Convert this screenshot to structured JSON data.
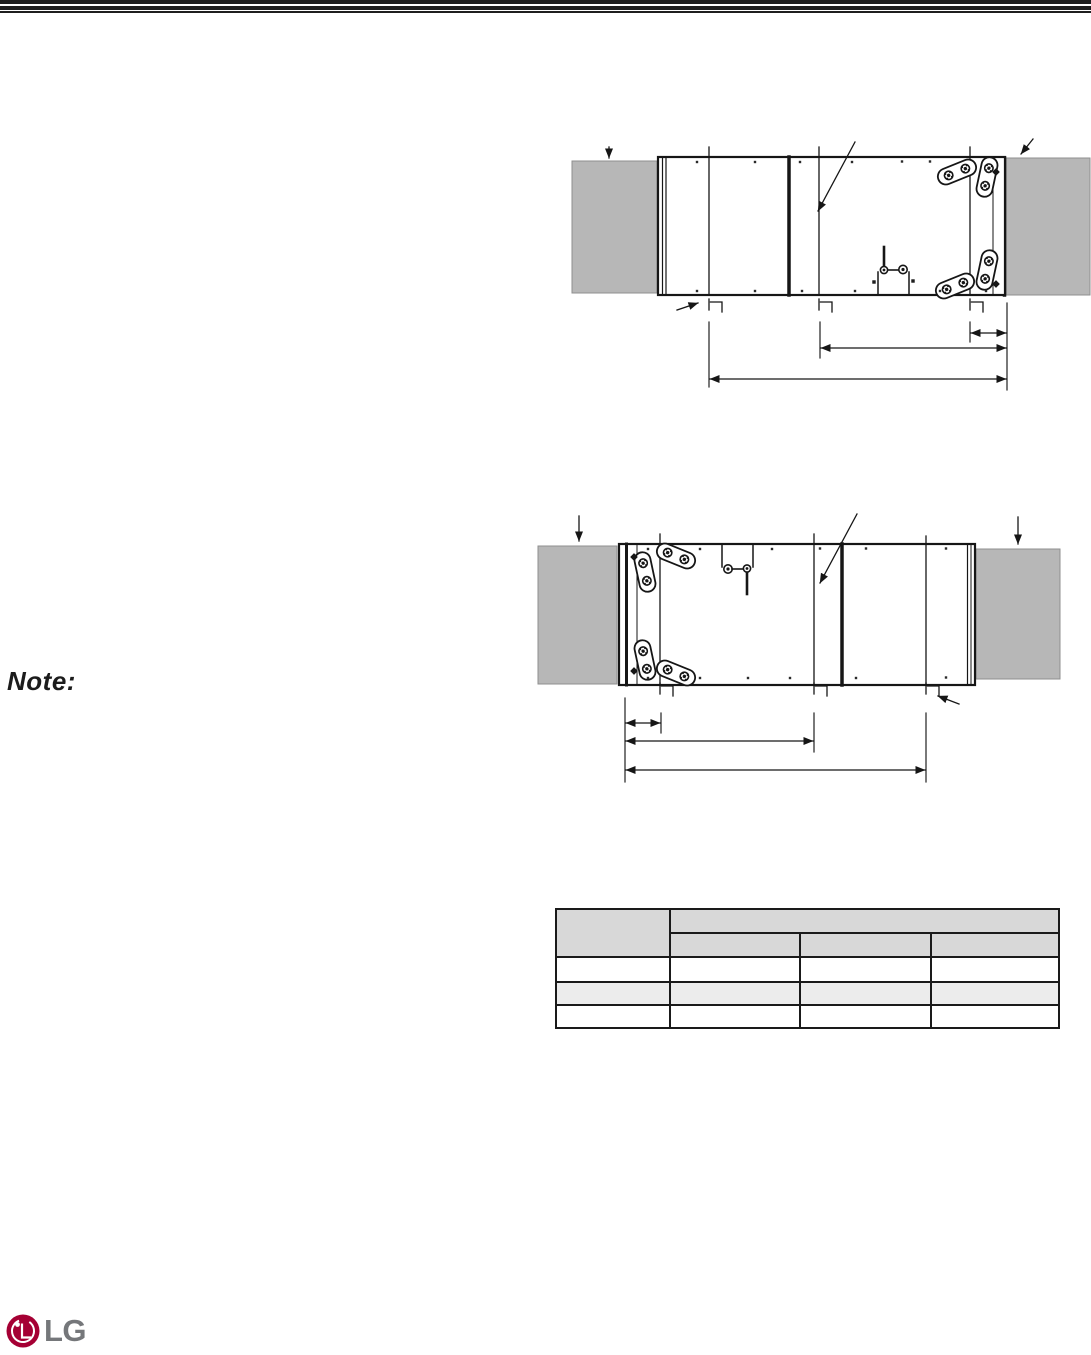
{
  "page": {
    "background": "#ffffff"
  },
  "header": {
    "bar_color": "#1f1f1f"
  },
  "note": {
    "label": "Note:"
  },
  "figures": {
    "panel_fill": "#b7b7b7",
    "line_color": "#161616",
    "top_figure": {
      "name": "unit-top-view-right-section-dimensions"
    },
    "bottom_figure": {
      "name": "unit-top-view-left-section-dimensions"
    }
  },
  "table": {
    "border_color": "#1a1a1a",
    "header_fill": "#d8d8d8",
    "alt_row_fill": "#ececec",
    "corner_header": "",
    "group_header": "",
    "sub_headers": [
      "",
      "",
      ""
    ],
    "rows": [
      [
        "",
        "",
        "",
        ""
      ],
      [
        "",
        "",
        "",
        ""
      ],
      [
        "",
        "",
        "",
        ""
      ]
    ]
  },
  "footer": {
    "logo_text": "LG",
    "logo_circle_color": "#a50034",
    "logo_text_color": "#75777a"
  }
}
